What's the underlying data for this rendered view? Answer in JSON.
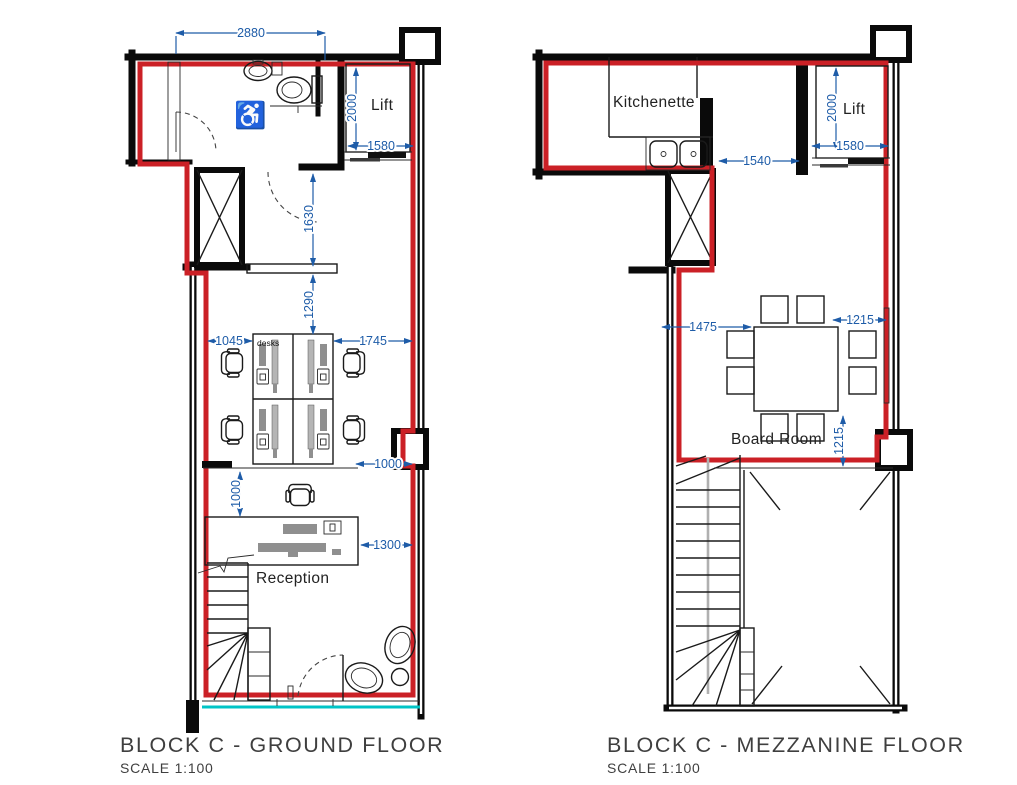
{
  "ground_floor": {
    "title": "BLOCK C - GROUND FLOOR",
    "scale": "SCALE 1:100",
    "labels": {
      "lift": "Lift",
      "desks": "desks",
      "reception": "Reception"
    },
    "dimensions": {
      "top_width": "2880",
      "lift_depth": "2000",
      "lift_width": "1580",
      "lobby_length": "1630",
      "hall_length": "1290",
      "wall_to_desks": "1045",
      "desks_to_wall": "1745",
      "desks_to_reception": "1000",
      "reception_clearance": "1000",
      "reception_desk_width": "1300"
    }
  },
  "mezzanine_floor": {
    "title": "BLOCK C - MEZZANINE FLOOR",
    "scale": "SCALE 1:100",
    "labels": {
      "kitchenette": "Kitchenette",
      "lift": "Lift",
      "board_room": "Board Room"
    },
    "dimensions": {
      "lift_depth": "2000",
      "lift_width": "1580",
      "corridor_width": "1540",
      "wall_to_table": "1475",
      "table_to_wall": "1215",
      "table_to_wall_below": "1215"
    }
  },
  "icons": {
    "wheelchair": "♿"
  },
  "colors": {
    "unit_outline_red": "#cb2026",
    "dimension_blue": "#1e5ca8",
    "glazing_cyan": "#00c4c6",
    "walls_black": "#0a0a0a"
  }
}
